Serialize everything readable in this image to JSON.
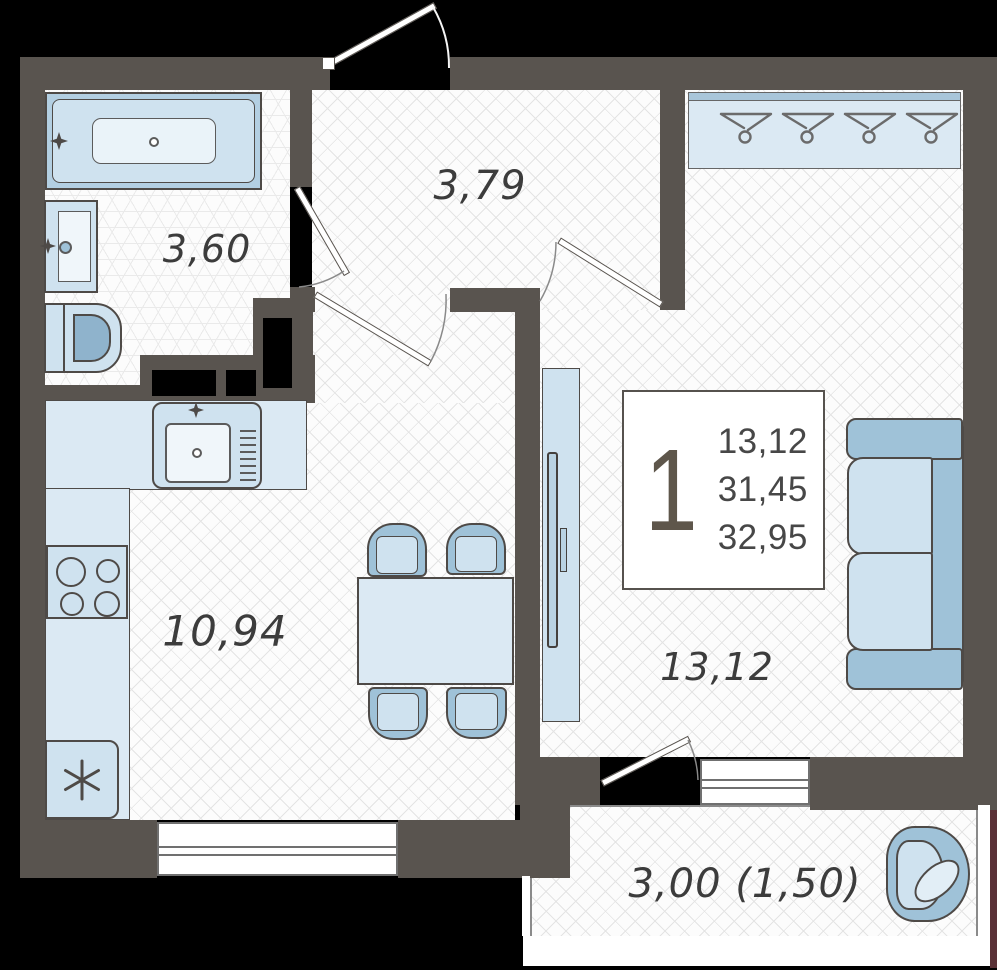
{
  "plan_type": "one-room-apartment-floor-plan",
  "info_box": {
    "room_count": "1",
    "values": [
      "13,12",
      "31,45",
      "32,95"
    ]
  },
  "rooms": {
    "bathroom": {
      "label": "3,60"
    },
    "hallway": {
      "label": "3,79"
    },
    "kitchen": {
      "label": "10,94"
    },
    "living_room": {
      "label": "13,12"
    },
    "balcony": {
      "label": "3,00 (1,50)"
    }
  },
  "icons": {
    "fridge": "snowflake-asterisk",
    "wardrobe": "clothes-hangers",
    "faucet": "four-point-star"
  },
  "colors": {
    "background": "#000000",
    "wall": "#59544f",
    "floor": "#fcfcfc",
    "floor_line": "#e4e4e4",
    "bath_line": "#eaeaea",
    "fixture_light": "#dbe9f3",
    "fixture_mid": "#cfe2ef",
    "fixture_deep": "#9fc2d8",
    "outline": "#4e4a47",
    "window_frame": "#707070",
    "label": "#3c3c3c",
    "info_number": "#474747",
    "room_count": "#5e564b",
    "accent_edge": "#5a3136",
    "white": "#ffffff"
  }
}
